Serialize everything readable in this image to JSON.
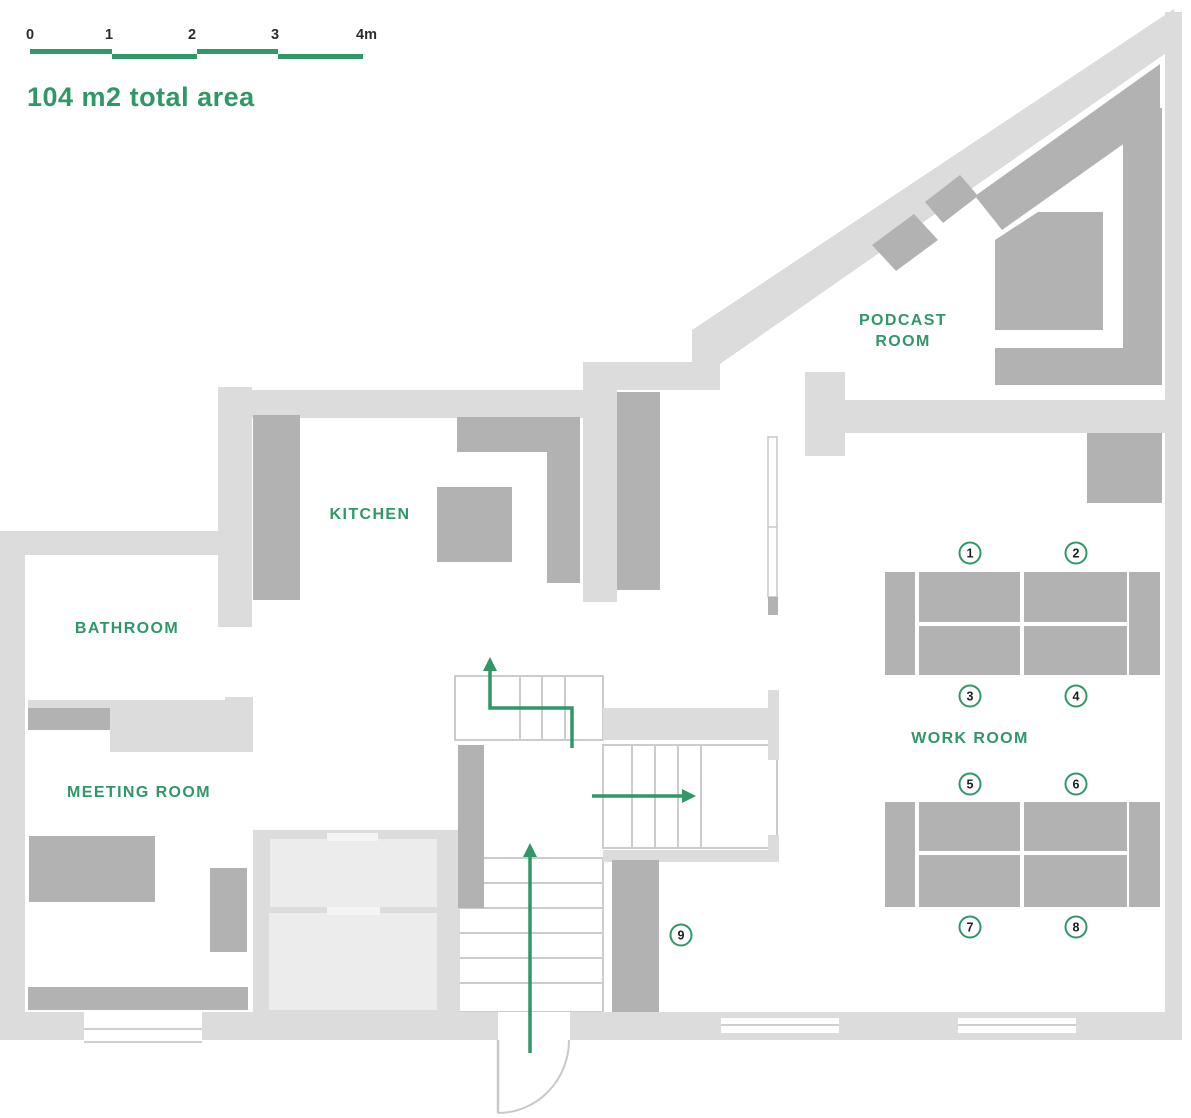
{
  "scale_bar": {
    "ticks": [
      "0",
      "1",
      "2",
      "3",
      "4m"
    ]
  },
  "total_area_label": "104 m2 total area",
  "rooms": {
    "podcast": {
      "line1": "PODCAST",
      "line2": "ROOM"
    },
    "kitchen": {
      "label": "KITCHEN"
    },
    "bathroom": {
      "label": "BATHROOM"
    },
    "meeting": {
      "label": "MEETING ROOM"
    },
    "work": {
      "label": "WORK ROOM"
    }
  },
  "workstations": {
    "labels": [
      "1",
      "2",
      "3",
      "4",
      "5",
      "6",
      "7",
      "8",
      "9"
    ]
  },
  "colors": {
    "accent_green": "#2f9768",
    "wall_gray": "#dcdcdc",
    "furniture_gray": "#b2b2b2",
    "booth_gray": "#ececec",
    "number_text": "#1e1e1e"
  }
}
